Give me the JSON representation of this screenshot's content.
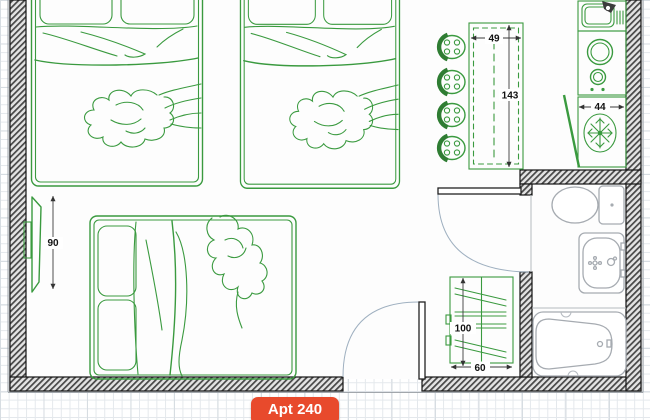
{
  "app": {
    "badge_label": "Apt 240"
  },
  "floorplan": {
    "dimensions": {
      "island_width": "49",
      "island_length": "143",
      "fridge_width": "44",
      "tv_length": "90",
      "shelf_height": "100",
      "shelf_width": "60"
    },
    "icons": [
      "snowflake-icon",
      "faucet-icon",
      "burner-icon",
      "door-arc"
    ],
    "colors": {
      "furniture_green": "#3a9a3f",
      "stool_accent_green": "#2f7d33",
      "wall_dark": "#141414",
      "fixture_gray": "#a6abb1",
      "door_arc_blue": "#9fb0c0",
      "badge_orange": "#e84a2c",
      "dimension_text": "#111111",
      "grid_line": "#e4e8ec"
    }
  }
}
